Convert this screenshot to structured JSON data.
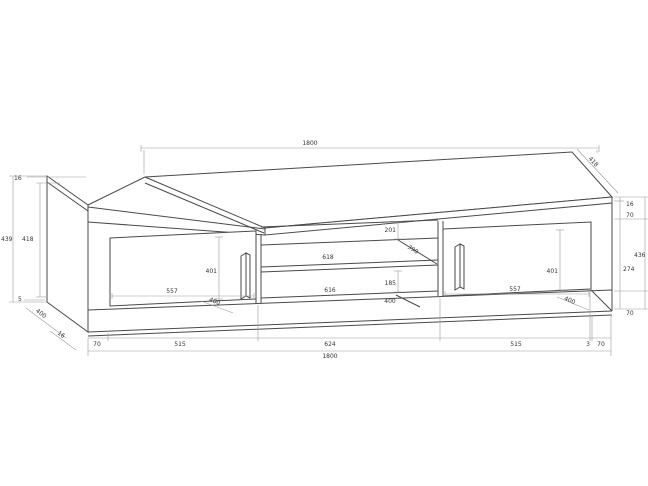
{
  "drawing": {
    "kind": "furniture technical drawing - TV lowboard with two doors and open shelf niche",
    "dims": {
      "top": {
        "width": "1800",
        "depth": "418"
      },
      "left": {
        "top_thickness": "16",
        "outer_height": "439",
        "inner_height": "418",
        "bottom_gap": "5",
        "depth": "400",
        "panel_thickness": "16"
      },
      "right": {
        "top_thickness": "16",
        "upper": "70",
        "middle": "274",
        "outer_height": "436",
        "lower": "70"
      },
      "bottom": {
        "segments": [
          "70",
          "515",
          "624",
          "515",
          "3",
          "70"
        ],
        "total": "1800"
      },
      "left_door": {
        "height": "401",
        "width": "557",
        "depth": "400"
      },
      "right_door": {
        "height": "401",
        "width": "557",
        "depth": "400"
      },
      "niche": {
        "upper_opening": "201",
        "shelf_depth": "390",
        "shelf_width": "618",
        "lower_opening": "185",
        "lower_width": "616",
        "bottom_depth": "400"
      }
    }
  }
}
